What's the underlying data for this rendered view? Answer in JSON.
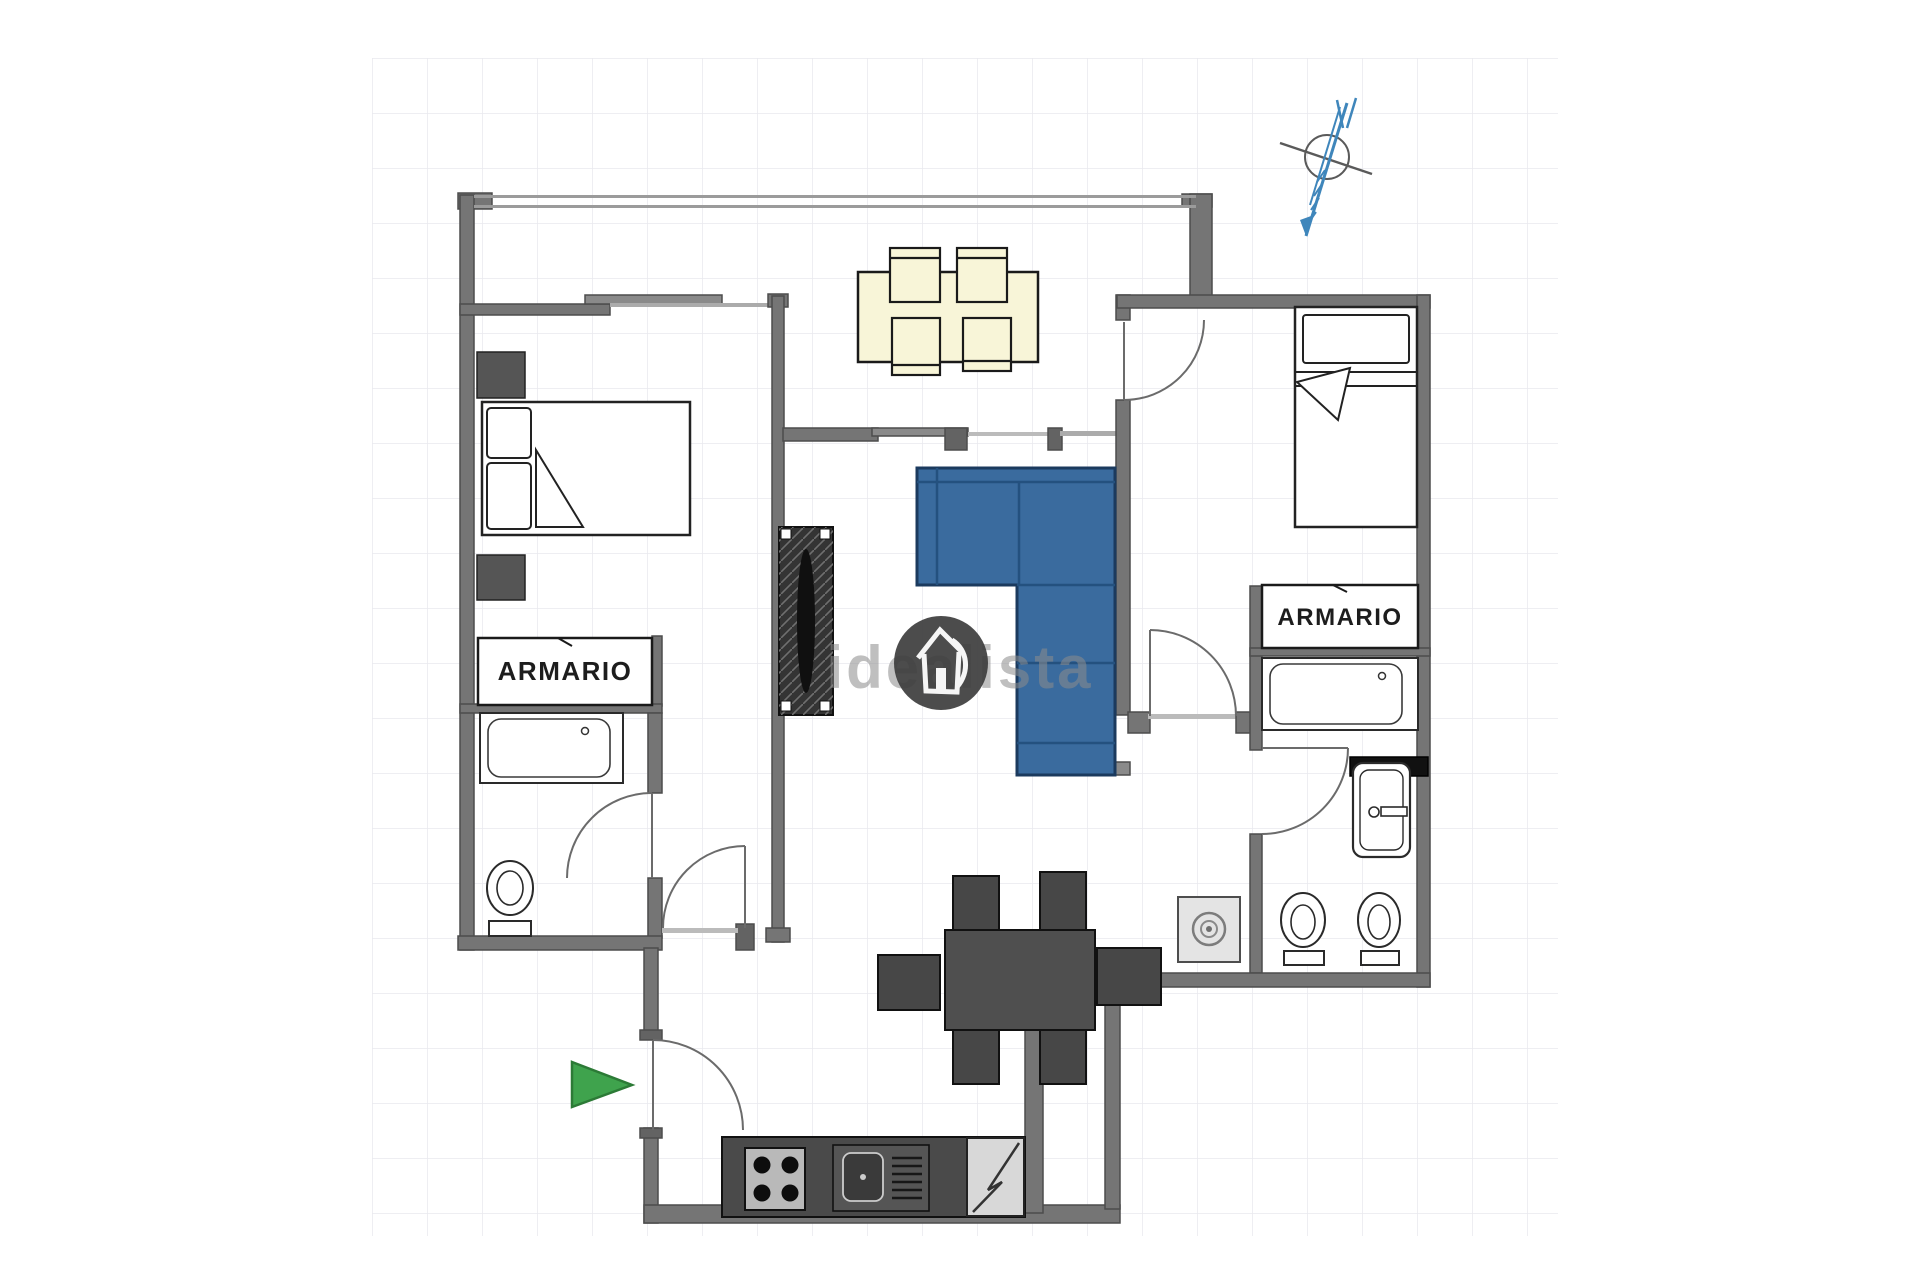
{
  "floorplan": {
    "labels": {
      "closet_left": "ARMARIO",
      "closet_right": "ARMARIO"
    },
    "watermark": {
      "text": "idealista"
    },
    "colors": {
      "wall": "#757575",
      "wall_dark": "#5d5d5d",
      "window_line": "#9b9b9b",
      "cream_furniture": "#f8f5d8",
      "sofa_blue": "#3a6b9e",
      "sofa_blue_dark": "#1b3a5e",
      "dark_furniture": "#4a4a4a",
      "radiator_dark": "#343434",
      "entrance_green": "#3fa34d",
      "compass_blue": "#3f86bb",
      "grid_line": "#e9e9ee",
      "watermark_gray": "#8c8c8c",
      "logo_circle": "#3d3d3d",
      "appliance_light": "#d8d8d8"
    },
    "fixtures": [
      "double-bed",
      "single-bed",
      "nightstand",
      "closet-left",
      "closet-right",
      "bathtub-left",
      "bathtub-right",
      "toilet-left",
      "toilet-right",
      "bidet",
      "washbasin",
      "washing-machine",
      "dining-table-cream",
      "dining-table-dark",
      "corner-sofa",
      "radiator-shelf",
      "kitchen-stove",
      "kitchen-sink",
      "refrigerator",
      "north-compass",
      "entrance-arrow"
    ]
  }
}
